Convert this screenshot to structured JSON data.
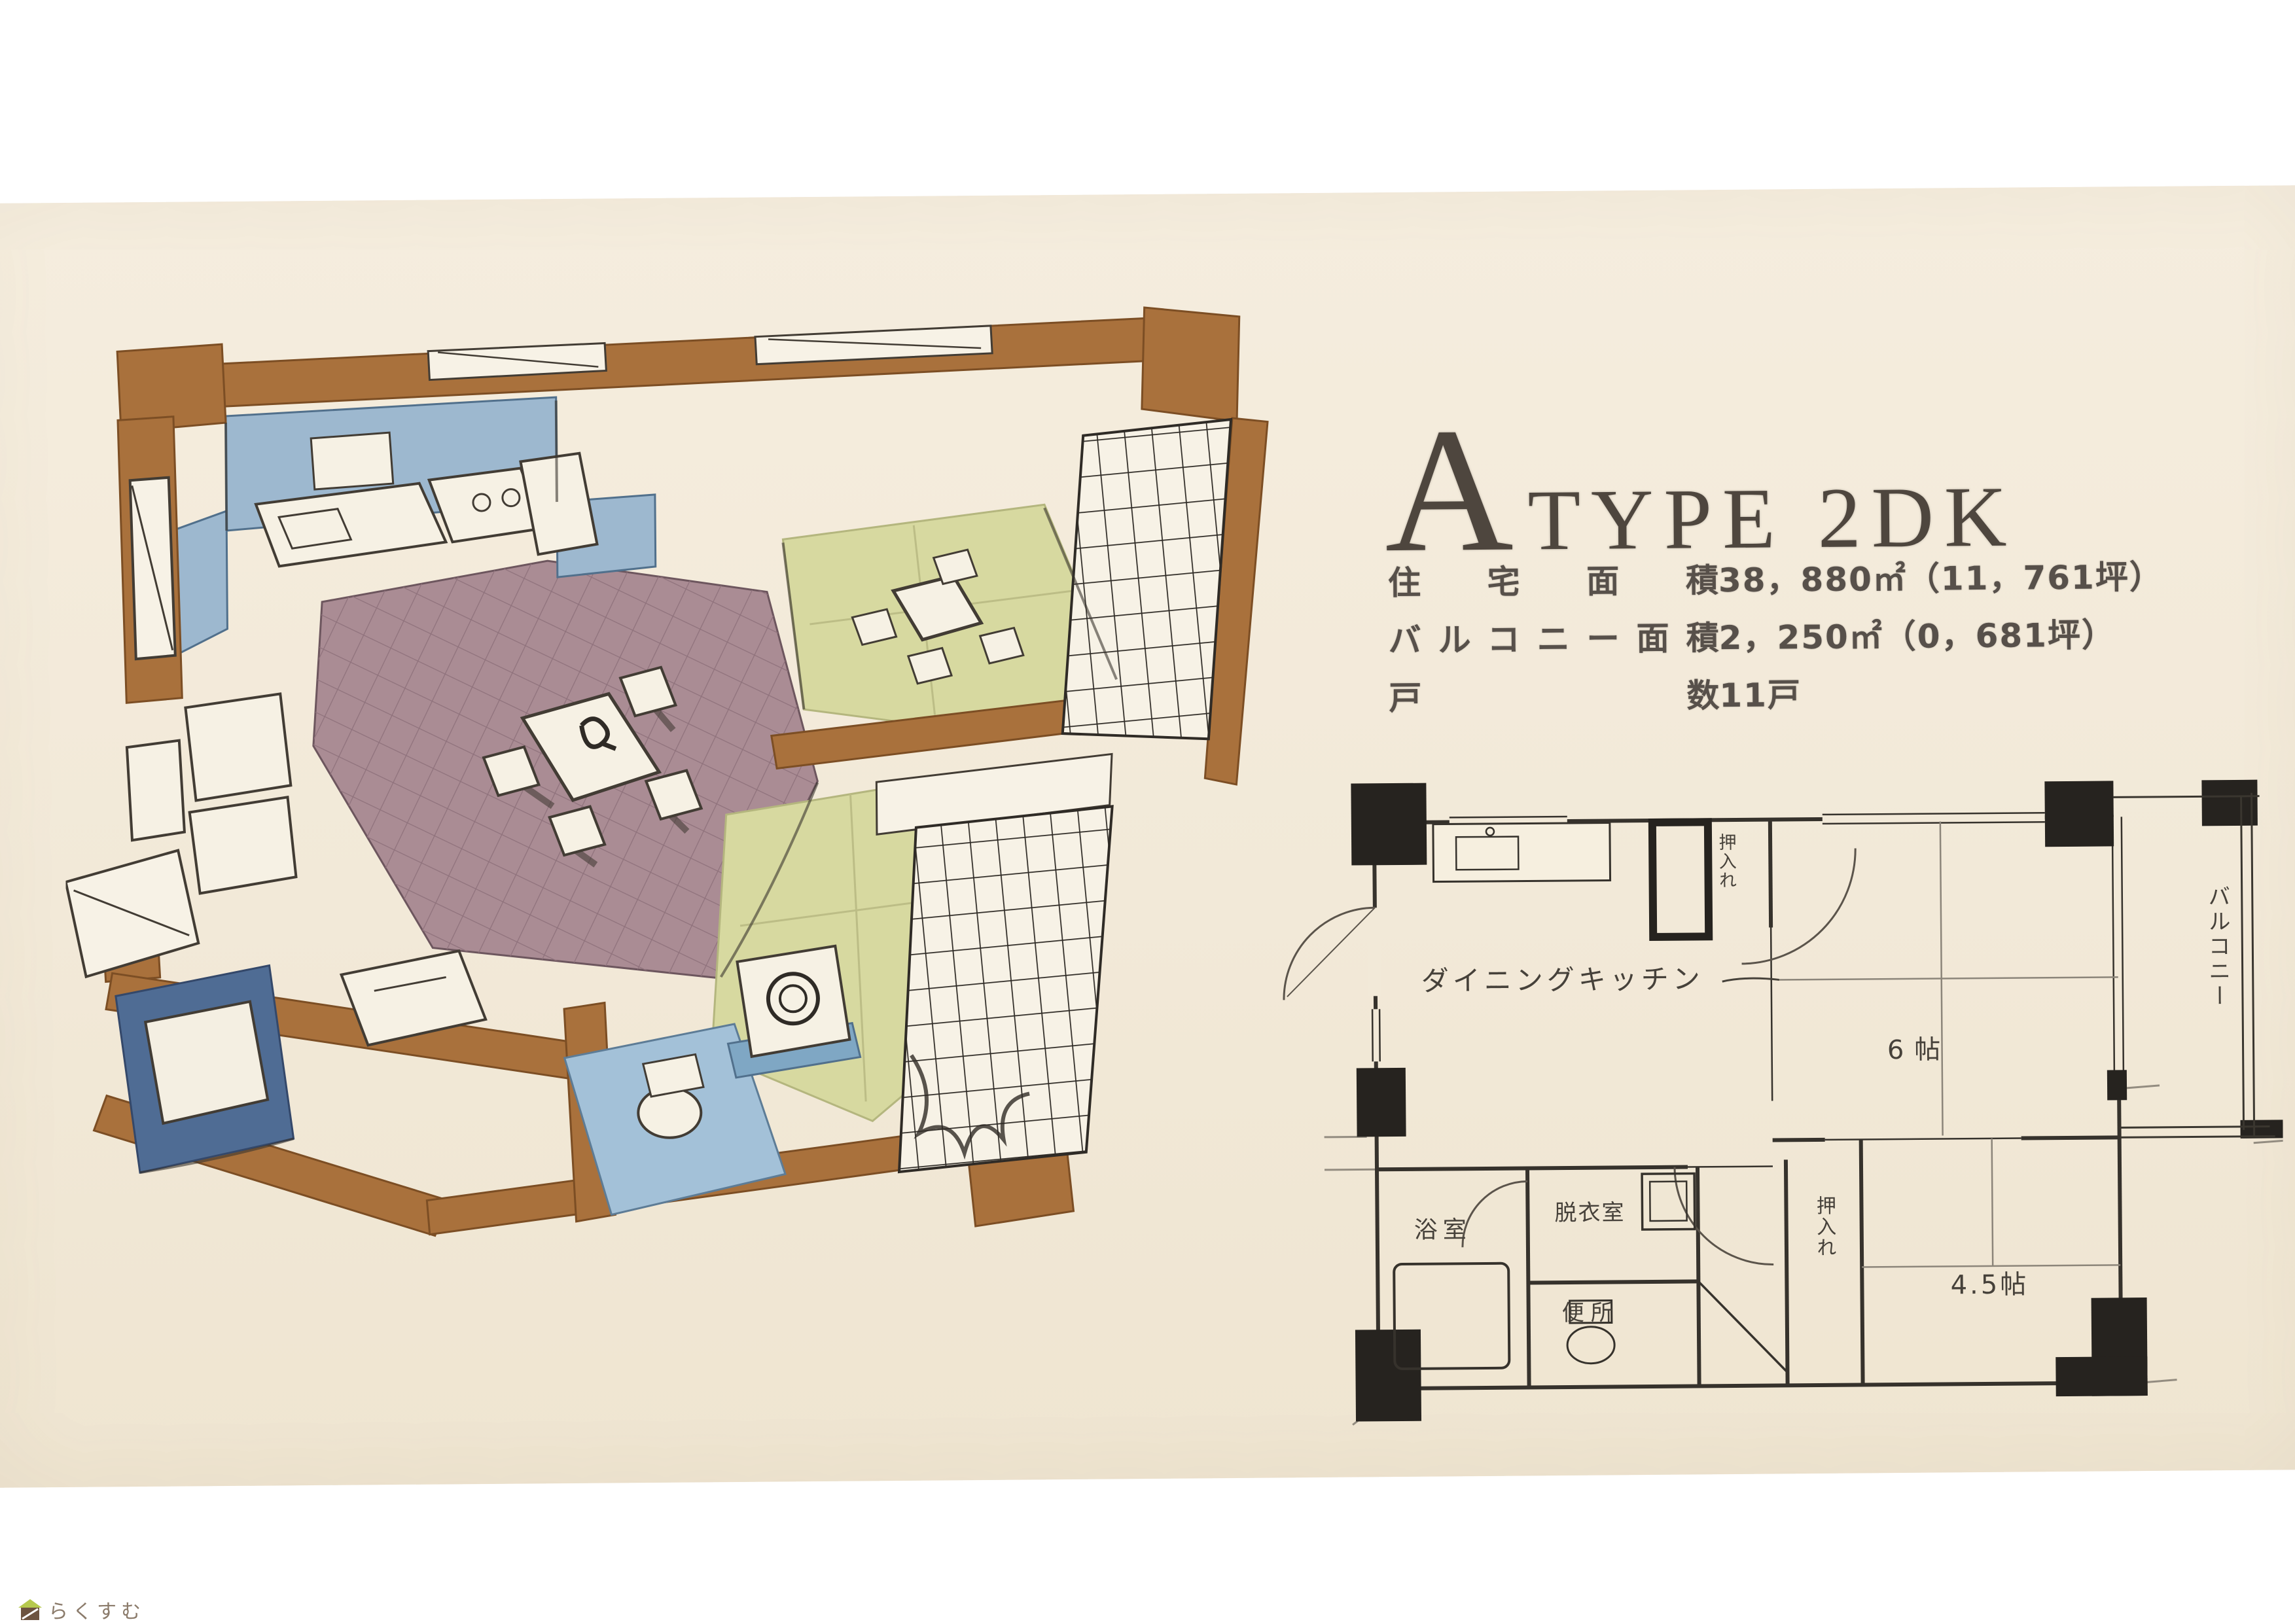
{
  "page": {
    "kind": "Scanned Japanese apartment brochure page",
    "paper_color": "#f2e9d8",
    "margin_color": "#ffffff"
  },
  "heading": {
    "initial": "A",
    "rest": "TYPE 2DK"
  },
  "specs": {
    "rows": [
      {
        "label": "住宅面積",
        "value": "38，880㎡（11，761坪）"
      },
      {
        "label": "バルコニー面積",
        "value": "2，250㎡（0，681坪）"
      },
      {
        "label": "戸数",
        "value": "11戸"
      }
    ]
  },
  "plan": {
    "dining_kitchen": "ダイニングキッチン",
    "room6": "6帖",
    "room45": "4.5帖",
    "balcony": "バルコニー",
    "bath": "浴室",
    "dressing": "脱衣室",
    "toilet": "便所",
    "closet": "押入れ",
    "closet_top": "押入れ"
  },
  "illustration": {
    "type": "hand-drawn axonometric cutaway of 2DK unit",
    "colors": {
      "wall_brown": "#a9713c",
      "wall_blue": "#9db8cf",
      "floor_mauve": "#aa8c94",
      "tatami_green": "#d7d9a0",
      "bath_tile_blue": "#4f6c94",
      "washroom_floor_blue": "#a3c1d8"
    }
  },
  "footer": {
    "logo_text": "らくすむ",
    "logo_roof_color": "#b6c94e",
    "logo_body_color": "#6d5340"
  }
}
